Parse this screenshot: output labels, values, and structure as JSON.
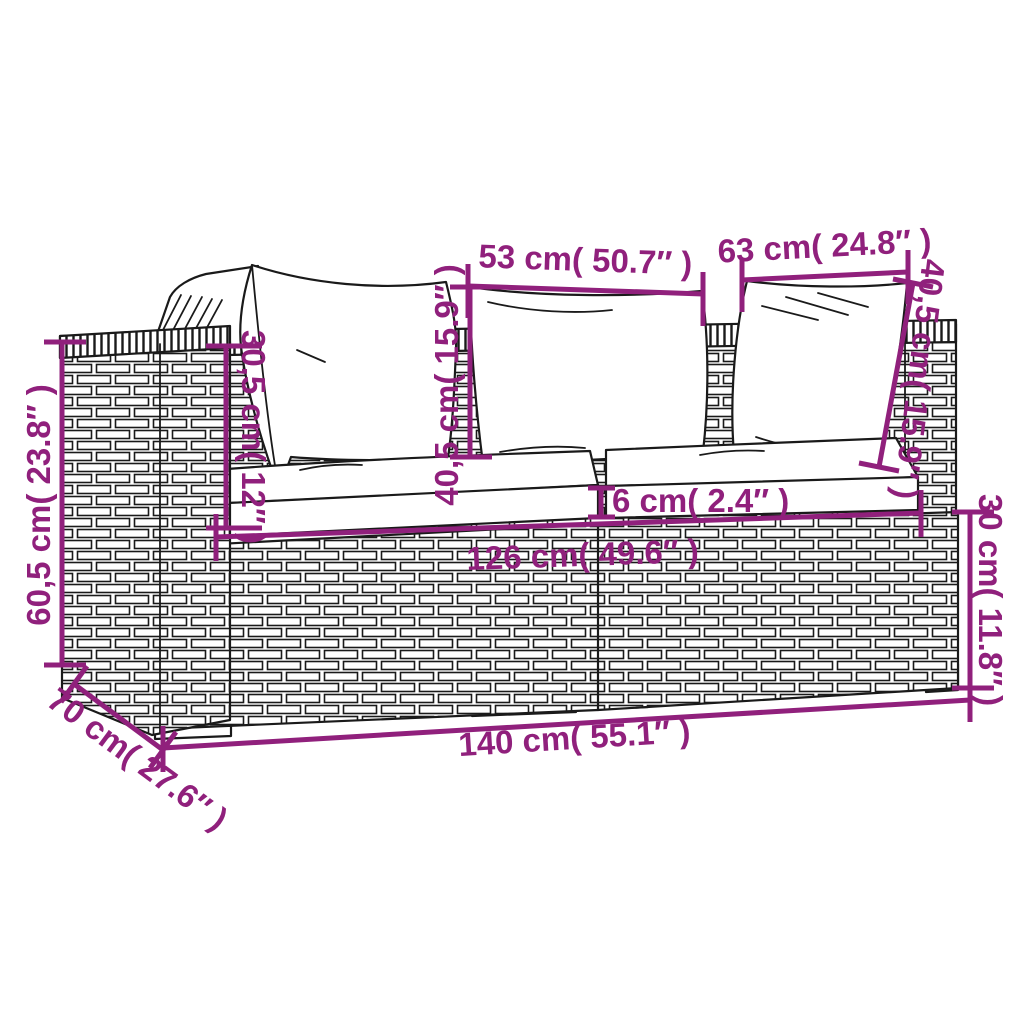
{
  "diagram": {
    "figure": "Two-seater poly rattan garden sofa with back pillows and seat cushions, technical dimension drawing",
    "colors": {
      "accent": "#90207C",
      "line_art": "#1a1a1a",
      "background": "#ffffff"
    },
    "annotations": {
      "back_pillow_left_width": "53 cm( 50.7″ )",
      "back_pillow_right_width": "63 cm( 24.8″ )",
      "back_pillow_height_center": "40,5 cm( 15.9″ )",
      "back_pillow_height_right": "40,5 cm( 15.9″ )",
      "backrest_above_seat_height": "30,5 cm( 12″ )",
      "armrest_height": "60,5 cm( 23.8″ )",
      "seat_cushion_thickness": "6 cm( 2.4″ )",
      "seat_width": "126 cm( 49.6″ )",
      "base_height": "30 cm( 11.8″ )",
      "total_width": "140 cm( 55.1″ )",
      "total_depth": "70 cm( 27.6″ )"
    }
  }
}
